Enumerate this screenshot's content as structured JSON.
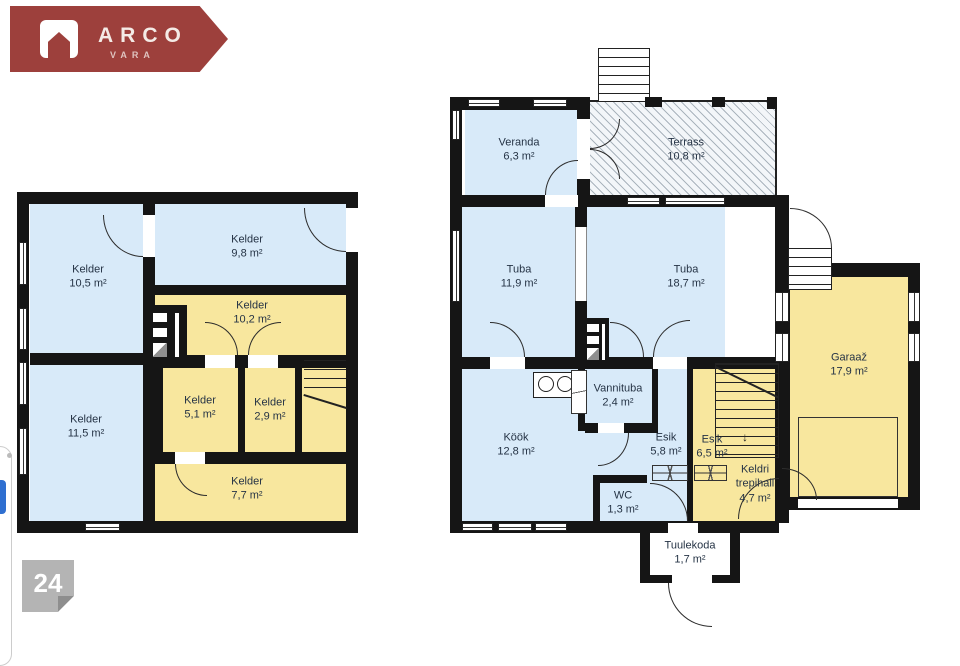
{
  "logo": {
    "brand": "ARCO",
    "sub": "VARA",
    "color": "#9d403c"
  },
  "page_badge": {
    "number": "24"
  },
  "colors": {
    "room_blue": "#d8eaf9",
    "room_yellow": "#f8e79e",
    "wall": "#151515",
    "text": "#253345"
  },
  "plans": {
    "left": {
      "title": "basement floor plan",
      "rooms": [
        {
          "name": "Kelder",
          "area": "10,5 m²"
        },
        {
          "name": "Kelder",
          "area": "9,8 m²"
        },
        {
          "name": "Kelder",
          "area": "10,2 m²"
        },
        {
          "name": "Kelder",
          "area": "11,5 m²"
        },
        {
          "name": "Kelder",
          "area": "5,1 m²"
        },
        {
          "name": "Kelder",
          "area": "2,9 m²"
        },
        {
          "name": "Kelder",
          "area": "7,7 m²"
        }
      ]
    },
    "right": {
      "title": "ground floor plan",
      "rooms": [
        {
          "name": "Veranda",
          "area": "6,3 m²"
        },
        {
          "name": "Terrass",
          "area": "10,8 m²"
        },
        {
          "name": "Tuba",
          "area": "11,9 m²"
        },
        {
          "name": "Tuba",
          "area": "18,7 m²"
        },
        {
          "name": "Garaaž",
          "area": "17,9 m²"
        },
        {
          "name": "Köök",
          "area": "12,8 m²"
        },
        {
          "name": "Vannituba",
          "area": "2,4 m²"
        },
        {
          "name": "Esik",
          "area": "5,8 m²"
        },
        {
          "name": "Esik",
          "area": "6,5 m²"
        },
        {
          "name": "WC",
          "area": "1,3 m²"
        },
        {
          "name": "Keldri trepihall",
          "area": "4,7 m²"
        },
        {
          "name": "Tuulekoda",
          "area": "1,7 m²"
        }
      ]
    }
  }
}
